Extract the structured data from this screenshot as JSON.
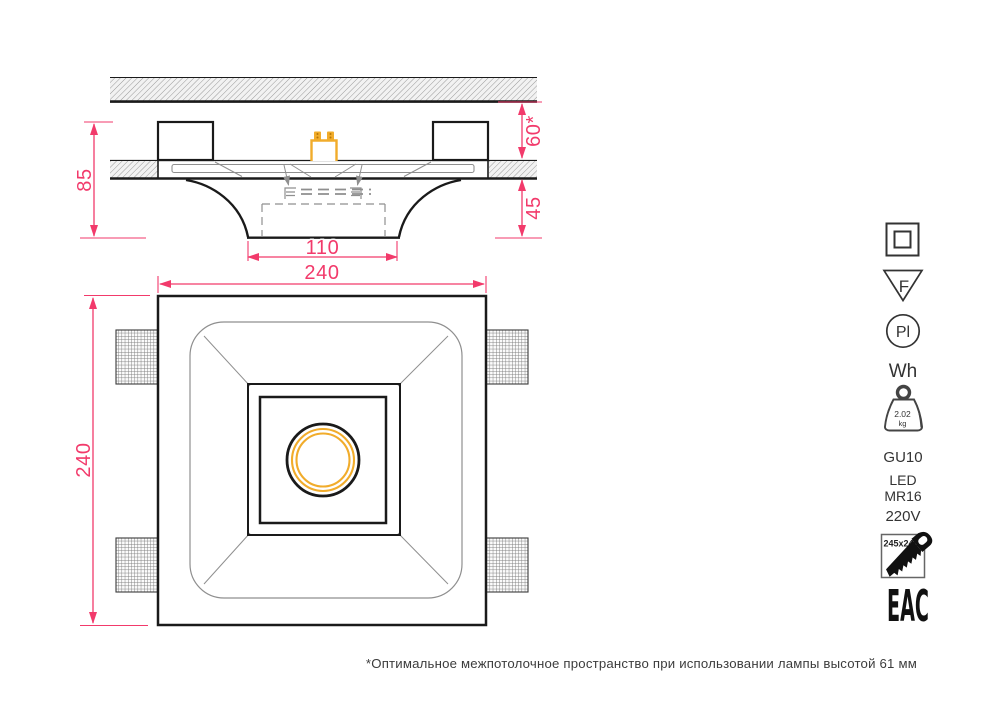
{
  "section_view": {
    "dim_total_height": "85",
    "dim_plenum": "60*",
    "dim_recess_depth": "45",
    "dim_opening_width": "110"
  },
  "plan_view": {
    "dim_width": "240",
    "dim_height": "240"
  },
  "spec_icons": {
    "class_icon": "double-square-insulation",
    "f_mark_label": "F",
    "pl_mark_label": "Pl",
    "finish_label": "Wh",
    "weight_value": "2.02",
    "weight_unit": "kg",
    "socket_label": "GU10",
    "lamp_line1": "LED",
    "lamp_line2": "MR16",
    "voltage_label": "220V",
    "cutout_label": "245x245",
    "certification_label": "EAC"
  },
  "footnote": "*Оптимальное межпотолочное пространство при использовании лампы высотой 61 мм",
  "colors": {
    "dimension_pink": "#F23A6B",
    "accent_yellow": "#F1AC2B",
    "line_black": "#1A1A1A",
    "line_grey": "#8F8F8F"
  }
}
